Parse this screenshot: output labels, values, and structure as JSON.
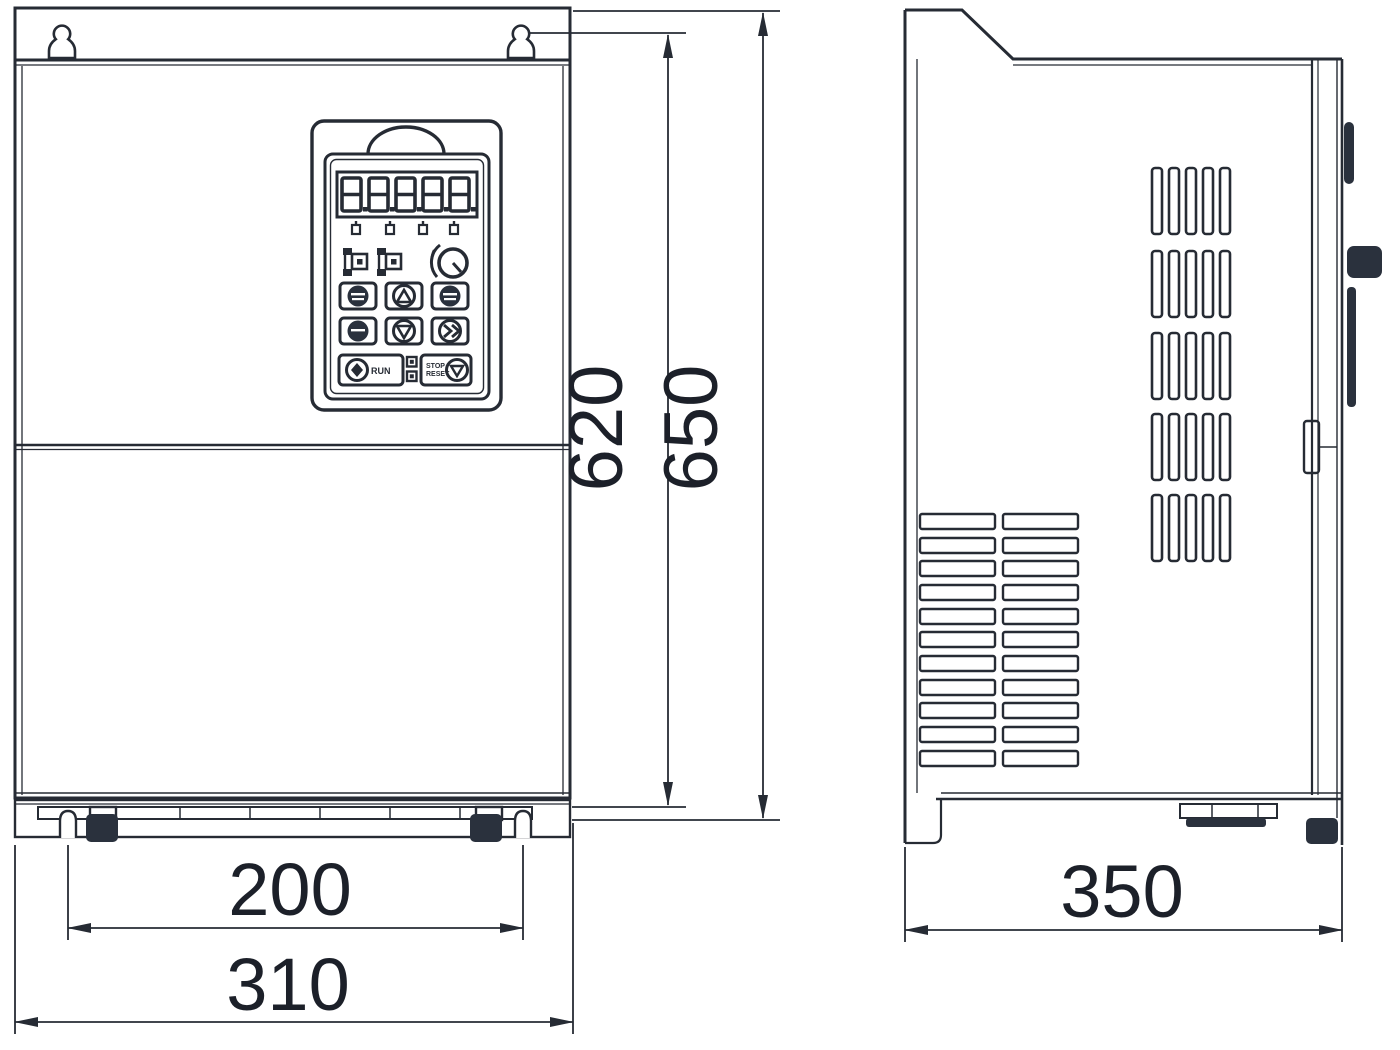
{
  "drawing": {
    "type": "technical-dimension-drawing",
    "subject": "frequency-inverter-enclosure-front-and-side-view",
    "dimensions": {
      "mounting_height": "620",
      "overall_height": "650",
      "mounting_hole_spacing_width": "200",
      "overall_width": "310",
      "depth": "350"
    },
    "keypad": {
      "display_value": "8.8.8.8.8",
      "run_button_label": "RUN",
      "stop_button_label_line1": "STOP",
      "stop_button_label_line2": "RESET",
      "button_icons": [
        "program-button",
        "up-button",
        "enter-button",
        "multifunction-button",
        "down-button",
        "shift-button",
        "run-button",
        "stop-reset-button"
      ],
      "indicator_icons": [
        "status-indicator-left",
        "status-indicator-right",
        "potentiometer-knob"
      ],
      "unit_indicator_count": "4"
    },
    "colors": {
      "line": "#262b34",
      "dark_fill": "#2a313d",
      "text": "#1c2029",
      "background": "#ffffff"
    }
  }
}
